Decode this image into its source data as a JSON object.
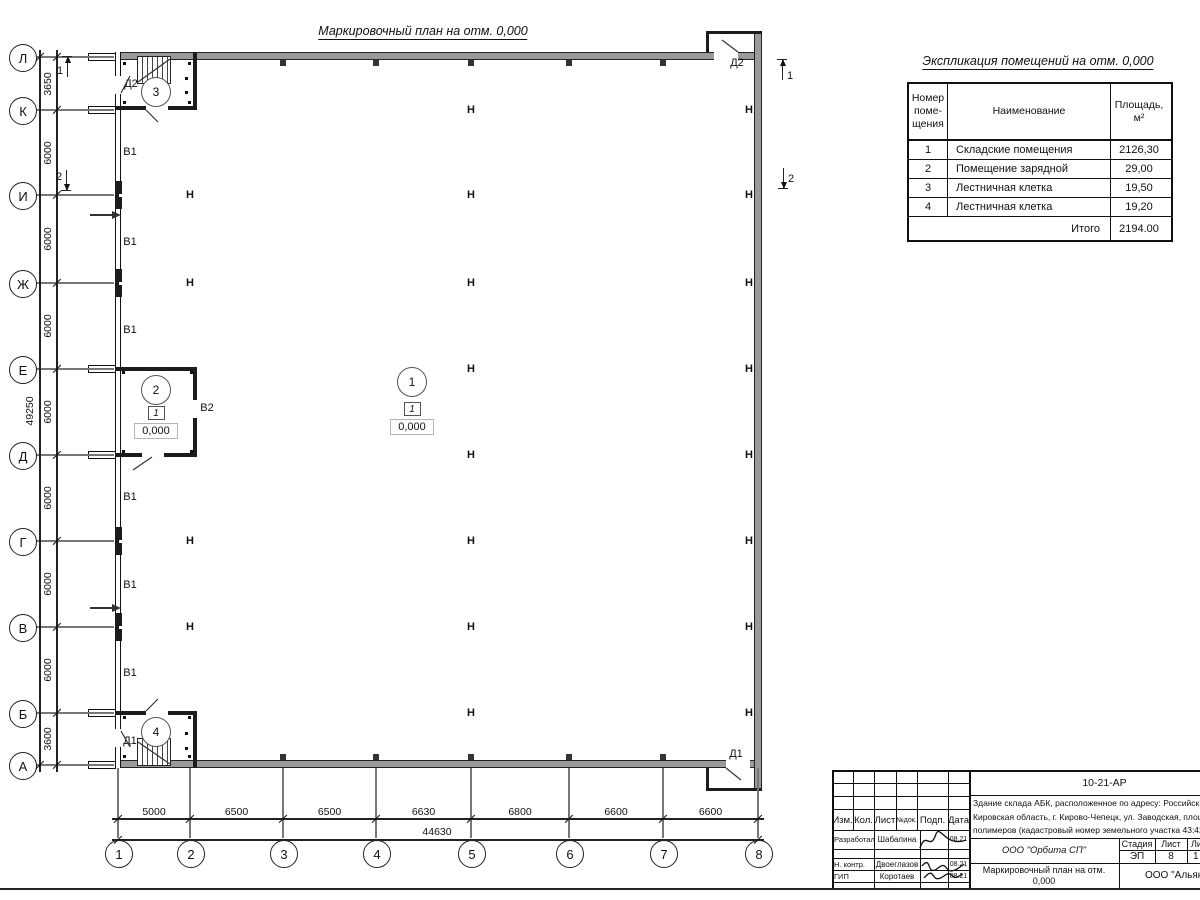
{
  "plan": {
    "title": "Маркировочный план на отм. 0,000",
    "column_mark": "Н",
    "room_marks": [
      {
        "num": "1",
        "x": 411,
        "y": 381,
        "floor_type": "1",
        "floor_x": 411,
        "floor_y": 408,
        "elev": "0,000",
        "elev_x": 411,
        "elev_y": 426
      },
      {
        "num": "2",
        "x": 155,
        "y": 389,
        "floor_type": "1",
        "floor_x": 155,
        "floor_y": 412,
        "elev": "0,000",
        "elev_x": 155,
        "elev_y": 430
      },
      {
        "num": "3",
        "x": 155,
        "y": 91
      },
      {
        "num": "4",
        "x": 155,
        "y": 731
      }
    ],
    "door_labels": [
      {
        "text": "Д2",
        "x": 131,
        "y": 84
      },
      {
        "text": "Д2",
        "x": 737,
        "y": 63
      },
      {
        "text": "Д1",
        "x": 130,
        "y": 741
      },
      {
        "text": "Д1",
        "x": 736,
        "y": 754
      }
    ],
    "gate_labels": [
      {
        "text": "В1",
        "x": 130,
        "y": 152
      },
      {
        "text": "В1",
        "x": 130,
        "y": 242
      },
      {
        "text": "В1",
        "x": 130,
        "y": 330
      },
      {
        "text": "В1",
        "x": 130,
        "y": 497
      },
      {
        "text": "В1",
        "x": 130,
        "y": 585
      },
      {
        "text": "В1",
        "x": 130,
        "y": 673
      },
      {
        "text": "В2",
        "x": 207,
        "y": 408
      }
    ],
    "h_marks": [
      {
        "x": 190,
        "y": 195
      },
      {
        "x": 190,
        "y": 283
      },
      {
        "x": 190,
        "y": 541
      },
      {
        "x": 190,
        "y": 627
      },
      {
        "x": 471,
        "y": 110
      },
      {
        "x": 471,
        "y": 195
      },
      {
        "x": 471,
        "y": 283
      },
      {
        "x": 471,
        "y": 369
      },
      {
        "x": 471,
        "y": 455
      },
      {
        "x": 471,
        "y": 541
      },
      {
        "x": 471,
        "y": 627
      },
      {
        "x": 471,
        "y": 713
      },
      {
        "x": 749,
        "y": 110
      },
      {
        "x": 749,
        "y": 195
      },
      {
        "x": 749,
        "y": 283
      },
      {
        "x": 749,
        "y": 369
      },
      {
        "x": 749,
        "y": 455
      },
      {
        "x": 749,
        "y": 541
      },
      {
        "x": 749,
        "y": 627
      },
      {
        "x": 749,
        "y": 713
      }
    ],
    "sections": [
      {
        "num": "1",
        "digit_x": 60,
        "digit_y": 71,
        "ax": 67,
        "y1": 57,
        "y2": 77,
        "dir": "up"
      },
      {
        "num": "2",
        "digit_x": 59,
        "digit_y": 177,
        "ax": 66,
        "y1": 170,
        "y2": 190,
        "dir": "down"
      },
      {
        "num": "1",
        "digit_x": 790,
        "digit_y": 76,
        "ax": 782,
        "y1": 60,
        "y2": 80,
        "dir": "up"
      },
      {
        "num": "2",
        "digit_x": 791,
        "digit_y": 179,
        "ax": 783,
        "y1": 168,
        "y2": 188,
        "dir": "down"
      }
    ]
  },
  "axes": {
    "rows": [
      {
        "label": "Л",
        "y": 57
      },
      {
        "label": "К",
        "y": 110
      },
      {
        "label": "И",
        "y": 195
      },
      {
        "label": "Ж",
        "y": 283
      },
      {
        "label": "Е",
        "y": 369
      },
      {
        "label": "Д",
        "y": 455
      },
      {
        "label": "Г",
        "y": 541
      },
      {
        "label": "В",
        "y": 627
      },
      {
        "label": "Б",
        "y": 713
      },
      {
        "label": "А",
        "y": 765
      }
    ],
    "cols": [
      {
        "label": "1",
        "x": 118
      },
      {
        "label": "2",
        "x": 190
      },
      {
        "label": "3",
        "x": 283
      },
      {
        "label": "4",
        "x": 376
      },
      {
        "label": "5",
        "x": 471
      },
      {
        "label": "6",
        "x": 569
      },
      {
        "label": "7",
        "x": 663
      },
      {
        "label": "8",
        "x": 758
      }
    ]
  },
  "dims": {
    "left_segments": [
      "3650",
      "6000",
      "6000",
      "6000",
      "6000",
      "6000",
      "6000",
      "6000",
      "3600"
    ],
    "left_total": "49250",
    "bottom_segments": [
      "5000",
      "6500",
      "6500",
      "6630",
      "6800",
      "6600",
      "6600"
    ],
    "bottom_total": "44630"
  },
  "explication": {
    "title": "Экспликация помещений на отм. 0,000",
    "col_num": "Номер\nпоме-\nщения",
    "col_name": "Наименование",
    "col_area": "Площадь,\nм²",
    "rows": [
      {
        "num": "1",
        "name": "Складские помещения",
        "area": "2126,30"
      },
      {
        "num": "2",
        "name": "Помещение зарядной",
        "area": "29,00"
      },
      {
        "num": "3",
        "name": "Лестничная клетка",
        "area": "19,50"
      },
      {
        "num": "4",
        "name": "Лестничная клетка",
        "area": "19,20"
      }
    ],
    "total_label": "Итого",
    "total_value": "2194.00"
  },
  "titleblock": {
    "doc_number": "10-21-АР",
    "address": "Здание склада АБК, расположенное по адресу: Российская Феде\nКировская область, г. Кирово-Чепецк, ул. Заводская, площадка з\nполимеров (кадастровый номер земельного участка 43:42:00000",
    "rev_cols": [
      "Изм.",
      "Кол.",
      "Лист",
      "№док.",
      "Подп.",
      "Дата"
    ],
    "people": [
      {
        "role": "Разработал",
        "name": "Шабалина",
        "date": "08.21"
      },
      {
        "role": "Н. контр.",
        "name": "Двоеглазов",
        "date": "08.21"
      },
      {
        "role": "ГИП",
        "name": "Коротаев",
        "date": "08.21"
      }
    ],
    "org1": "ООО \"Орбита СП\"",
    "stage_label": "Стадия",
    "sheet_label": "Лист",
    "sheets_label": "Листов",
    "stage_value": "ЭП",
    "sheet_value": "8",
    "sheets_value": "1",
    "drawing_name": "Маркировочный план на отм. 0,000",
    "org2": "ООО \"Альянс"
  }
}
